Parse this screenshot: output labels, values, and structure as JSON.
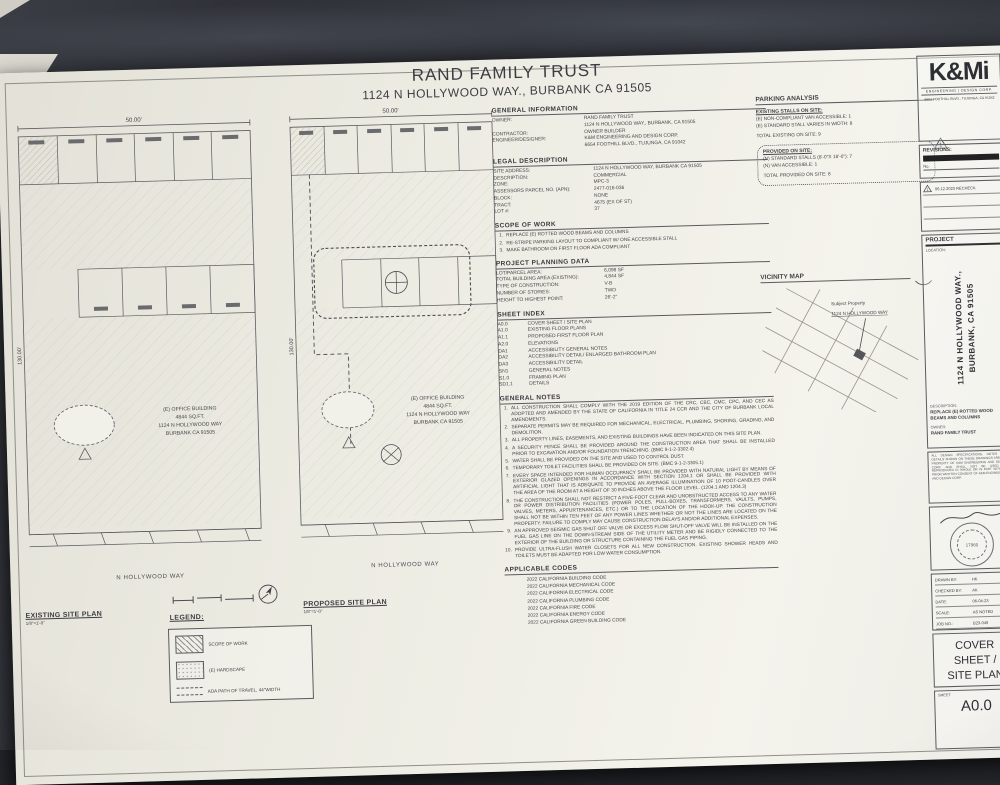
{
  "title": {
    "line1": "RAND FAMILY TRUST",
    "line2": "1124 N HOLLYWOOD WAY., BURBANK CA 91505"
  },
  "sections": {
    "general_information": {
      "heading": "GENERAL INFORMATION",
      "rows": [
        {
          "label": "OWNER:",
          "value": "RAND FAMILY TRUST"
        },
        {
          "label": "",
          "value": "1124 N HOLLYWOOD WAY., BURBANK, CA 91505"
        },
        {
          "label": "CONTRACTOR:",
          "value": "OWNER BUILDER"
        },
        {
          "label": "ENGINEER/DESIGNER:",
          "value": "K&M ENGINEERING AND DESIGN CORP."
        },
        {
          "label": "",
          "value": "6654 FOOTHILL BLVD., TUJUNGA, CA 91042"
        }
      ]
    },
    "legal_description": {
      "heading": "LEGAL DESCRIPTION",
      "rows": [
        {
          "label": "SITE ADDRESS:",
          "value": "1124 N HOLLYWOOD WAY, BURBANK CA 91505"
        },
        {
          "label": "DESCRIPTION:",
          "value": "COMMERCIAL"
        },
        {
          "label": "ZONE:",
          "value": "MPC-3"
        },
        {
          "label": "ASSESSORS PARCEL NO. (APN):",
          "value": "2477-016-036"
        },
        {
          "label": "BLOCK:",
          "value": "NONE"
        },
        {
          "label": "TRACT:",
          "value": "4675 (EX OF ST)"
        },
        {
          "label": "LOT #:",
          "value": "37"
        }
      ]
    },
    "scope_of_work": {
      "heading": "SCOPE OF WORK",
      "items": [
        "REPLACE (E) ROTTED WOOD BEAMS AND COLUMNS",
        "RE-STRIPE PARKING LAYOUT TO COMPLIANT W/ ONE ACCESSIBLE STALL",
        "MAKE BATHROOM ON FIRST FLOOR ADA COMPLIANT"
      ]
    },
    "project_planning": {
      "heading": "PROJECT PLANNING DATA",
      "rows": [
        {
          "label": "LOT/PARCEL AREA:",
          "value": "6,098 SF"
        },
        {
          "label": "TOTAL BUILDING AREA (EXISTING):",
          "value": "4,844 SF"
        },
        {
          "label": "TYPE OF CONSTRUCTION:",
          "value": "V-B"
        },
        {
          "label": "NUMBER OF STORIES:",
          "value": "TWO"
        },
        {
          "label": "HEIGHT TO HIGHEST POINT:",
          "value": "26'-2\""
        }
      ]
    },
    "sheet_index": {
      "heading": "SHEET INDEX",
      "rows": [
        {
          "no": "A0.0",
          "title": "COVER SHEET / SITE PLAN"
        },
        {
          "no": "A1.0",
          "title": "EXISTING FLOOR PLANS"
        },
        {
          "no": "A1.1",
          "title": "PROPOSED FIRST FLOOR PLAN"
        },
        {
          "no": "A2.0",
          "title": "ELEVATIONS"
        },
        {
          "no": "DA1",
          "title": "ACCESSIBILITY GENERAL NOTES"
        },
        {
          "no": "DA2",
          "title": "ACCESSIBILITY DETAIL/ ENLARGED BATHROOM PLAN"
        },
        {
          "no": "DA3",
          "title": "ACCESSIBILITY DETAIL"
        },
        {
          "no": "SN1",
          "title": "GENERAL NOTES"
        },
        {
          "no": "S1.0",
          "title": "FRAMING PLAN"
        },
        {
          "no": "SD1.1",
          "title": "DETAILS"
        }
      ]
    },
    "general_notes": {
      "heading": "GENERAL NOTES",
      "items": [
        "ALL CONSTRUCTION SHALL COMPLY WITH THE 2019 EDITION OF THE CRC, CBC, CMC, CPC, AND CEC AS ADOPTED AND AMENDED BY THE STATE OF CALIFORNIA IN TITLE 24 CCR AND THE CITY OF BURBANK LOCAL AMENDMENTS.",
        "SEPARATE PERMITS MAY BE REQUIRED FOR MECHANICAL, ELECTRICAL, PLUMBING, SHORING, GRADING, AND DEMOLITION.",
        "ALL PROPERTY LINES, EASEMENTS, AND EXISTING BUILDINGS HAVE BEEN INDICATED ON THIS SITE PLAN.",
        "A SECURITY FENCE SHALL BE PROVIDED AROUND THE CONSTRUCTION AREA THAT SHALL BE INSTALLED PRIOR TO EXCAVATION AND/OR FOUNDATION TRENCHING. (BMC 9-1-2-3302.4)",
        "WATER SHALL BE PROVIDED ON THE SITE AND USED TO CONTROL DUST.",
        "TEMPORARY TOILET FACILITIES SHALL BE PROVIDED ON SITE. (BMC 9-1-2-3305.1)",
        "EVERY SPACE INTENDED FOR HUMAN OCCUPANCY SHALL BE PROVIDED WITH NATURAL LIGHT BY MEANS OF EXTERIOR GLAZED OPENINGS IN ACCORDANCE WITH SECTION 1204.1 OR SHALL BE PROVIDED WITH ARTIFICIAL LIGHT THAT IS ADEQUATE TO PROVIDE AN AVERAGE ILLUMINATION OF 10 FOOT-CANDLES OVER THE AREA OF THE ROOM AT A HEIGHT OF 30 INCHES ABOVE THE FLOOR LEVEL. (1204.1 AND 1204.3)",
        "THE CONSTRUCTION SHALL NOT RESTRICT A FIVE-FOOT CLEAR AND UNOBSTRUCTED ACCESS TO ANY WATER OR POWER DISTRIBUTION FACILITIES (POWER POLES, PULL-BOXES, TRANSFORMERS, VAULTS, PUMPS, VALVES, METERS, APPURTENANCES, ETC.) OR TO THE LOCATION OF THE HOOK-UP. THE CONSTRUCTION SHALL NOT BE WITHIN TEN FEET OF ANY POWER LINES WHETHER OR NOT THE LINES ARE LOCATED ON THE PROPERTY. FAILURE TO COMPLY MAY CAUSE CONSTRUCTION DELAYS AND/OR ADDITIONAL EXPENSES.",
        "AN APPROVED SEISMIC GAS SHUT OFF VALVE OR EXCESS FLOW SHUT-OFF VALVE WILL BE INSTALLED ON THE FUEL GAS LINE ON THE DOWN-STREAM SIDE OF THE UTILITY METER AND BE RIGIDLY CONNECTED TO THE EXTERIOR OF THE BUILDING OR STRUCTURE CONTAINING THE FUEL GAS PIPING.",
        "PROVIDE ULTRA-FLUSH WATER CLOSETS FOR ALL NEW CONSTRUCTION. EXISTING SHOWER HEADS AND TOILETS MUST BE ADAPTED FOR LOW WATER CONSUMPTION."
      ]
    },
    "applicable_codes": {
      "heading": "APPLICABLE CODES",
      "items": [
        "2022 CALIFORNIA BUILDING CODE",
        "2022 CALIFORNIA MECHANICAL CODE",
        "2022 CALIFORNIA ELECTRICAL CODE",
        "2022 CALIFORNIA PLUMBING CODE",
        "2022 CALIFORNIA FIRE CODE",
        "2022 CALIFORNIA ENERGY CODE",
        "2022 CALIFORNIA GREEN BUILDING CODE"
      ]
    }
  },
  "parking": {
    "heading": "PARKING ANALYSIS",
    "existing_heading": "EXISTING STALLS ON SITE:",
    "existing_lines": [
      "(E) NON-COMPLIANT VAN ACCESSIBLE: 1",
      "(E) STANDARD STALL VARIES IN WIDTH: 8"
    ],
    "total_existing": "TOTAL EXISTING ON SITE: 9",
    "provided_heading": "PROVIDED ON SITE:",
    "provided_lines": [
      "(N) STANDARD STALLS (8'-0\"X 18'-0\"): 7",
      "(N) VAN ACCESSIBLE: 1"
    ],
    "total_provided": "TOTAL PROVIDED ON SITE: 8",
    "marker": "1"
  },
  "vicinity": {
    "heading": "VICINITY MAP",
    "note1": "Subject Property",
    "note2": "1124 N HOLLYWOOD WAY"
  },
  "plans": {
    "existing": {
      "title": "EXISTING SITE PLAN",
      "scale": "1/8\"=1'-0\"",
      "street": "N HOLLYWOOD WAY",
      "width_dim": "50.00'",
      "depth_dim": "130.00'",
      "building_label": [
        "(E) OFFICE BUILDING",
        "4844 SQ.FT.",
        "1124 N HOLLYWOOD WAY",
        "BURBANK CA 91505"
      ]
    },
    "proposed": {
      "title": "PROPOSED SITE PLAN",
      "scale": "1/8\"=1'-0\"",
      "street": "N HOLLYWOOD WAY",
      "width_dim": "50.00'",
      "depth_dim": "130.00'",
      "building_label": [
        "(E) OFFICE BUILDING",
        "4844 SQ.FT.",
        "1124 N HOLLYWOOD WAY",
        "BURBANK CA 91505"
      ]
    }
  },
  "legend": {
    "heading": "LEGEND:",
    "items": [
      "SCOPE OF WORK",
      "(E) HARDSCAPE",
      "ADA PATH OF TRAVEL, 44\"WIDTH"
    ]
  },
  "titleblock": {
    "logo": {
      "name": "K&Mi",
      "tagline": "ENGINEERING | DESIGN CORP.",
      "address": "6654 FOOTHILL BLVD., TUJUNGA, CA 91042"
    },
    "revisions_label": "REVISIONS:",
    "no_label": "No.",
    "revision": {
      "no": "1",
      "text": "06.12.2023 RECHECK"
    },
    "project_label": "PROJECT",
    "location_label": "LOCATION:",
    "location_line1": "1124 N HOLLYWOOD WAY.,",
    "location_line2": "BURBANK, CA 91505",
    "description_label": "DESCRIPTION:",
    "description_text": "REPLACE (E) ROTTED WOOD BEAMS AND COLUMNS",
    "owner_label": "OWNER:",
    "owner_text": "RAND FAMILY TRUST",
    "disclaimer": "ALL DESIGN SPECIFICATIONS, NOTES AND DETAILS SHOWN ON THESE DRAWINGS ARE THE PROPERTY OF K&M ENGINEERING AND DESIGN CORP. AND SHALL NOT BE USED OR REPRODUCED IN WHOLE OR IN PART WITHOUT PRIOR WRITTEN CONSENT OF K&M ENGINEERING AND DESIGN CORP.",
    "stamp_number": "17960",
    "info_rows": [
      {
        "label": "DRAWN BY:",
        "value": "HK"
      },
      {
        "label": "CHECKED BY:",
        "value": "AK"
      },
      {
        "label": "DATE:",
        "value": "06-04-23"
      },
      {
        "label": "SCALE:",
        "value": "AS NOTED"
      },
      {
        "label": "JOB NO.:",
        "value": "B23-049"
      }
    ],
    "sheet_title_lines": [
      "COVER",
      "SHEET /",
      "SITE PLAN"
    ],
    "sheet_label": "SHEET",
    "sheet_number": "A0.0"
  }
}
